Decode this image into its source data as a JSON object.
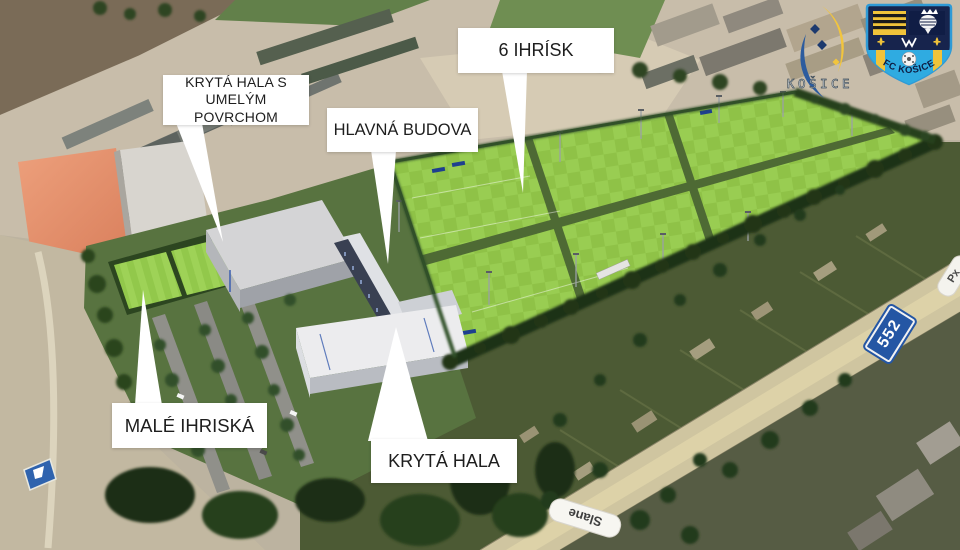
{
  "callouts": {
    "indoor_hall_artificial_surface": {
      "line1": "KRYTÁ HALA S",
      "line2": "UMELÝM POVRCHOM"
    },
    "main_building": {
      "label": "HLAVNÁ BUDOVA"
    },
    "six_pitches": {
      "label": "6 IHRÍSK"
    },
    "small_pitches": {
      "label": "MALÉ IHRISKÁ"
    },
    "indoor_hall": {
      "label": "KRYTÁ HALA"
    }
  },
  "logos": {
    "city": {
      "label": "KOŠICE"
    },
    "club": {
      "label": "FC KOŠICE"
    }
  },
  "map_labels": {
    "road_number": "552",
    "street_name": "Slane",
    "street_name_partial": "Px"
  },
  "colors": {
    "pitch_green": "#8fc247",
    "hedge_green": "#2e4824",
    "callout_bg": "#ffffff",
    "callout_text": "#1e1e1e",
    "road_sign_blue": "#2456a4",
    "club_navy": "#17244d",
    "club_yellow": "#f0c33a",
    "club_light_blue": "#2fabe1",
    "city_yellow": "#f2c53d",
    "city_blue": "#2d5c9e"
  }
}
